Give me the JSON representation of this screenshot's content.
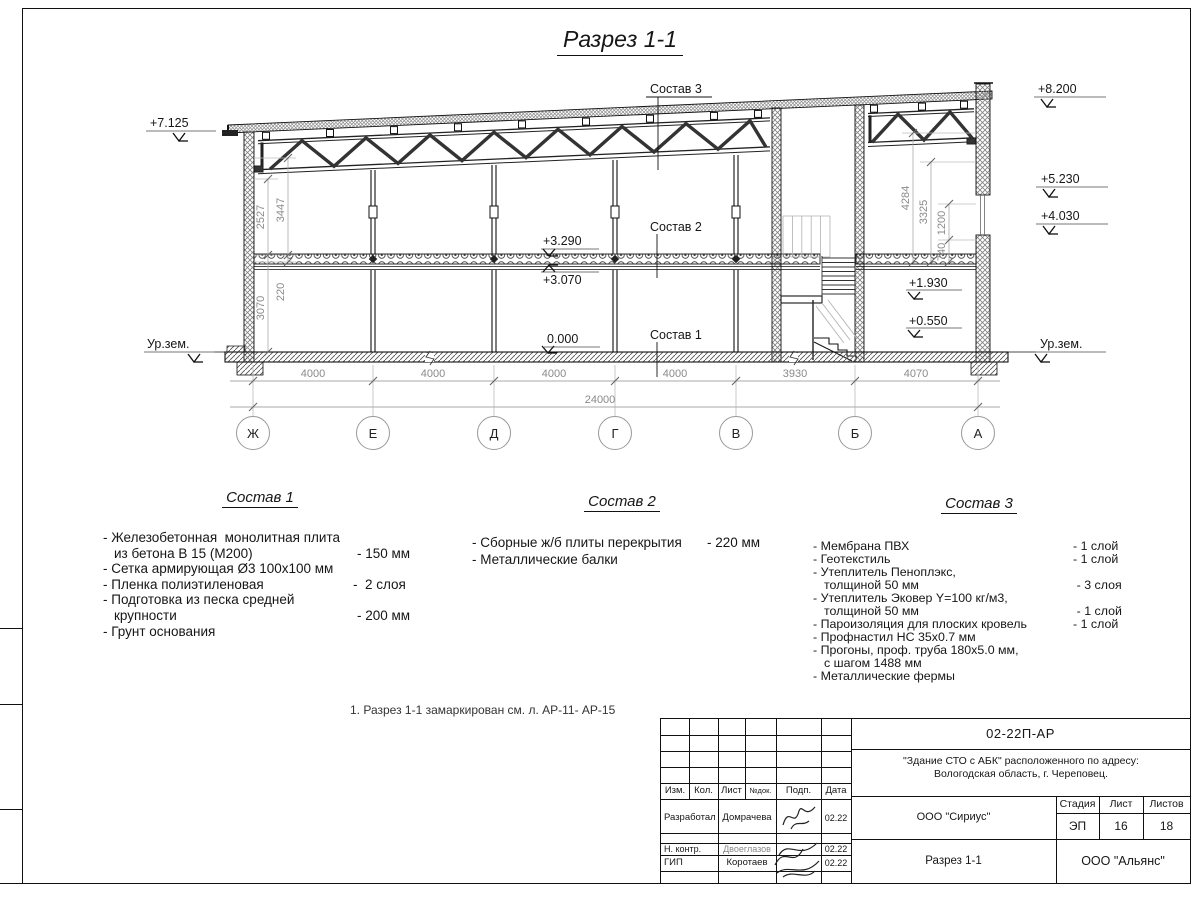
{
  "title": "Разрез 1-1",
  "drawing": {
    "elev_left_top": "+7.125",
    "elev_right_top": "+8.200",
    "elev_right_mid": "+5.230",
    "elev_right_low": "+4.030",
    "elev_slab_top": "+3.290",
    "elev_slab_bot": "+3.070",
    "elev_floor": "0.000",
    "elev_stair_up": "+1.930",
    "elev_stair_low": "+0.550",
    "ground_left": "Ур.зем.",
    "ground_right": "Ур.зем.",
    "sostav1_label": "Состав 1",
    "sostav2_label": "Состав 2",
    "sostav3_label": "Состав 3",
    "vdims_left": [
      "2527",
      "3447",
      "220",
      "3070"
    ],
    "vdims_right": [
      "4284",
      "3325",
      "1200",
      "740"
    ],
    "bottom_dims": [
      "4000",
      "4000",
      "4000",
      "4000",
      "3930",
      "4070"
    ],
    "total_dim": "24000",
    "axes": [
      "Ж",
      "Е",
      "Д",
      "Г",
      "В",
      "Б",
      "А"
    ]
  },
  "spec1": {
    "heading": "Состав 1",
    "rows": [
      {
        "text": "- Железобетонная  монолитная плита",
        "value": ""
      },
      {
        "text": "из бетона В 15 (М200)",
        "value": "- 150 мм"
      },
      {
        "text": "- Сетка армирующая Ø3 100х100 мм",
        "value": ""
      },
      {
        "text": "- Пленка полиэтиленовая",
        "value": "-  2 слоя"
      },
      {
        "text": "- Подготовка из песка средней",
        "value": ""
      },
      {
        "text": "крупности",
        "value": "- 200 мм"
      },
      {
        "text": "- Грунт основания",
        "value": ""
      }
    ]
  },
  "spec2": {
    "heading": "Состав 2",
    "rows": [
      {
        "text": "- Сборные ж/б плиты перекрытия",
        "value": "- 220 мм"
      },
      {
        "text": "- Металлические балки",
        "value": ""
      }
    ]
  },
  "spec3": {
    "heading": "Состав 3",
    "rows": [
      {
        "text": "- Мембрана ПВХ",
        "value": "- 1 слой"
      },
      {
        "text": "- Геотекстиль",
        "value": "- 1 слой"
      },
      {
        "text": "- Утеплитель Пеноплэкс,",
        "value": ""
      },
      {
        "text": "толщиной 50 мм",
        "value": "- 3 слоя"
      },
      {
        "text": "- Утеплитель Эковер Y=100 кг/м3,",
        "value": ""
      },
      {
        "text": "толщиной 50 мм",
        "value": "- 1 слой"
      },
      {
        "text": "- Пароизоляция для плоских кровель",
        "value": "- 1 слой"
      },
      {
        "text": "- Профнастил НС 35х0.7 мм",
        "value": ""
      },
      {
        "text": "- Прогоны, проф. труба 180х5.0 мм,",
        "value": ""
      },
      {
        "text": "с шагом 1488 мм",
        "value": ""
      },
      {
        "text": "- Металлические фермы",
        "value": ""
      }
    ]
  },
  "note": "1. Разрез 1-1 замаркирован см. л. АР-11- АР-15",
  "titleblock": {
    "doc_number": "02-22П-АР",
    "project_line1": "\"Здание СТО с АБК\" расположенного по адресу:",
    "project_line2": "Вологодская область, г. Череповец.",
    "columns": [
      "Изм.",
      "Кол.",
      "Лист",
      "№док.",
      "Подп.",
      "Дата"
    ],
    "rows": [
      {
        "role": "Разработал",
        "name": "Домрачева",
        "date": "02.22"
      },
      {
        "role": "Н. контр.",
        "name": "Двоеглазов",
        "date": "02.22"
      },
      {
        "role": "ГИП",
        "name": "Коротаев",
        "date": "02.22"
      }
    ],
    "org1": "ООО \"Сириус\"",
    "org2": "ООО \"Альянс\"",
    "stage_label": "Стадия",
    "sheet_label": "Лист",
    "sheets_label": "Листов",
    "stage": "ЭП",
    "sheet": "16",
    "sheets": "18",
    "drawing_name": "Разрез 1-1"
  }
}
